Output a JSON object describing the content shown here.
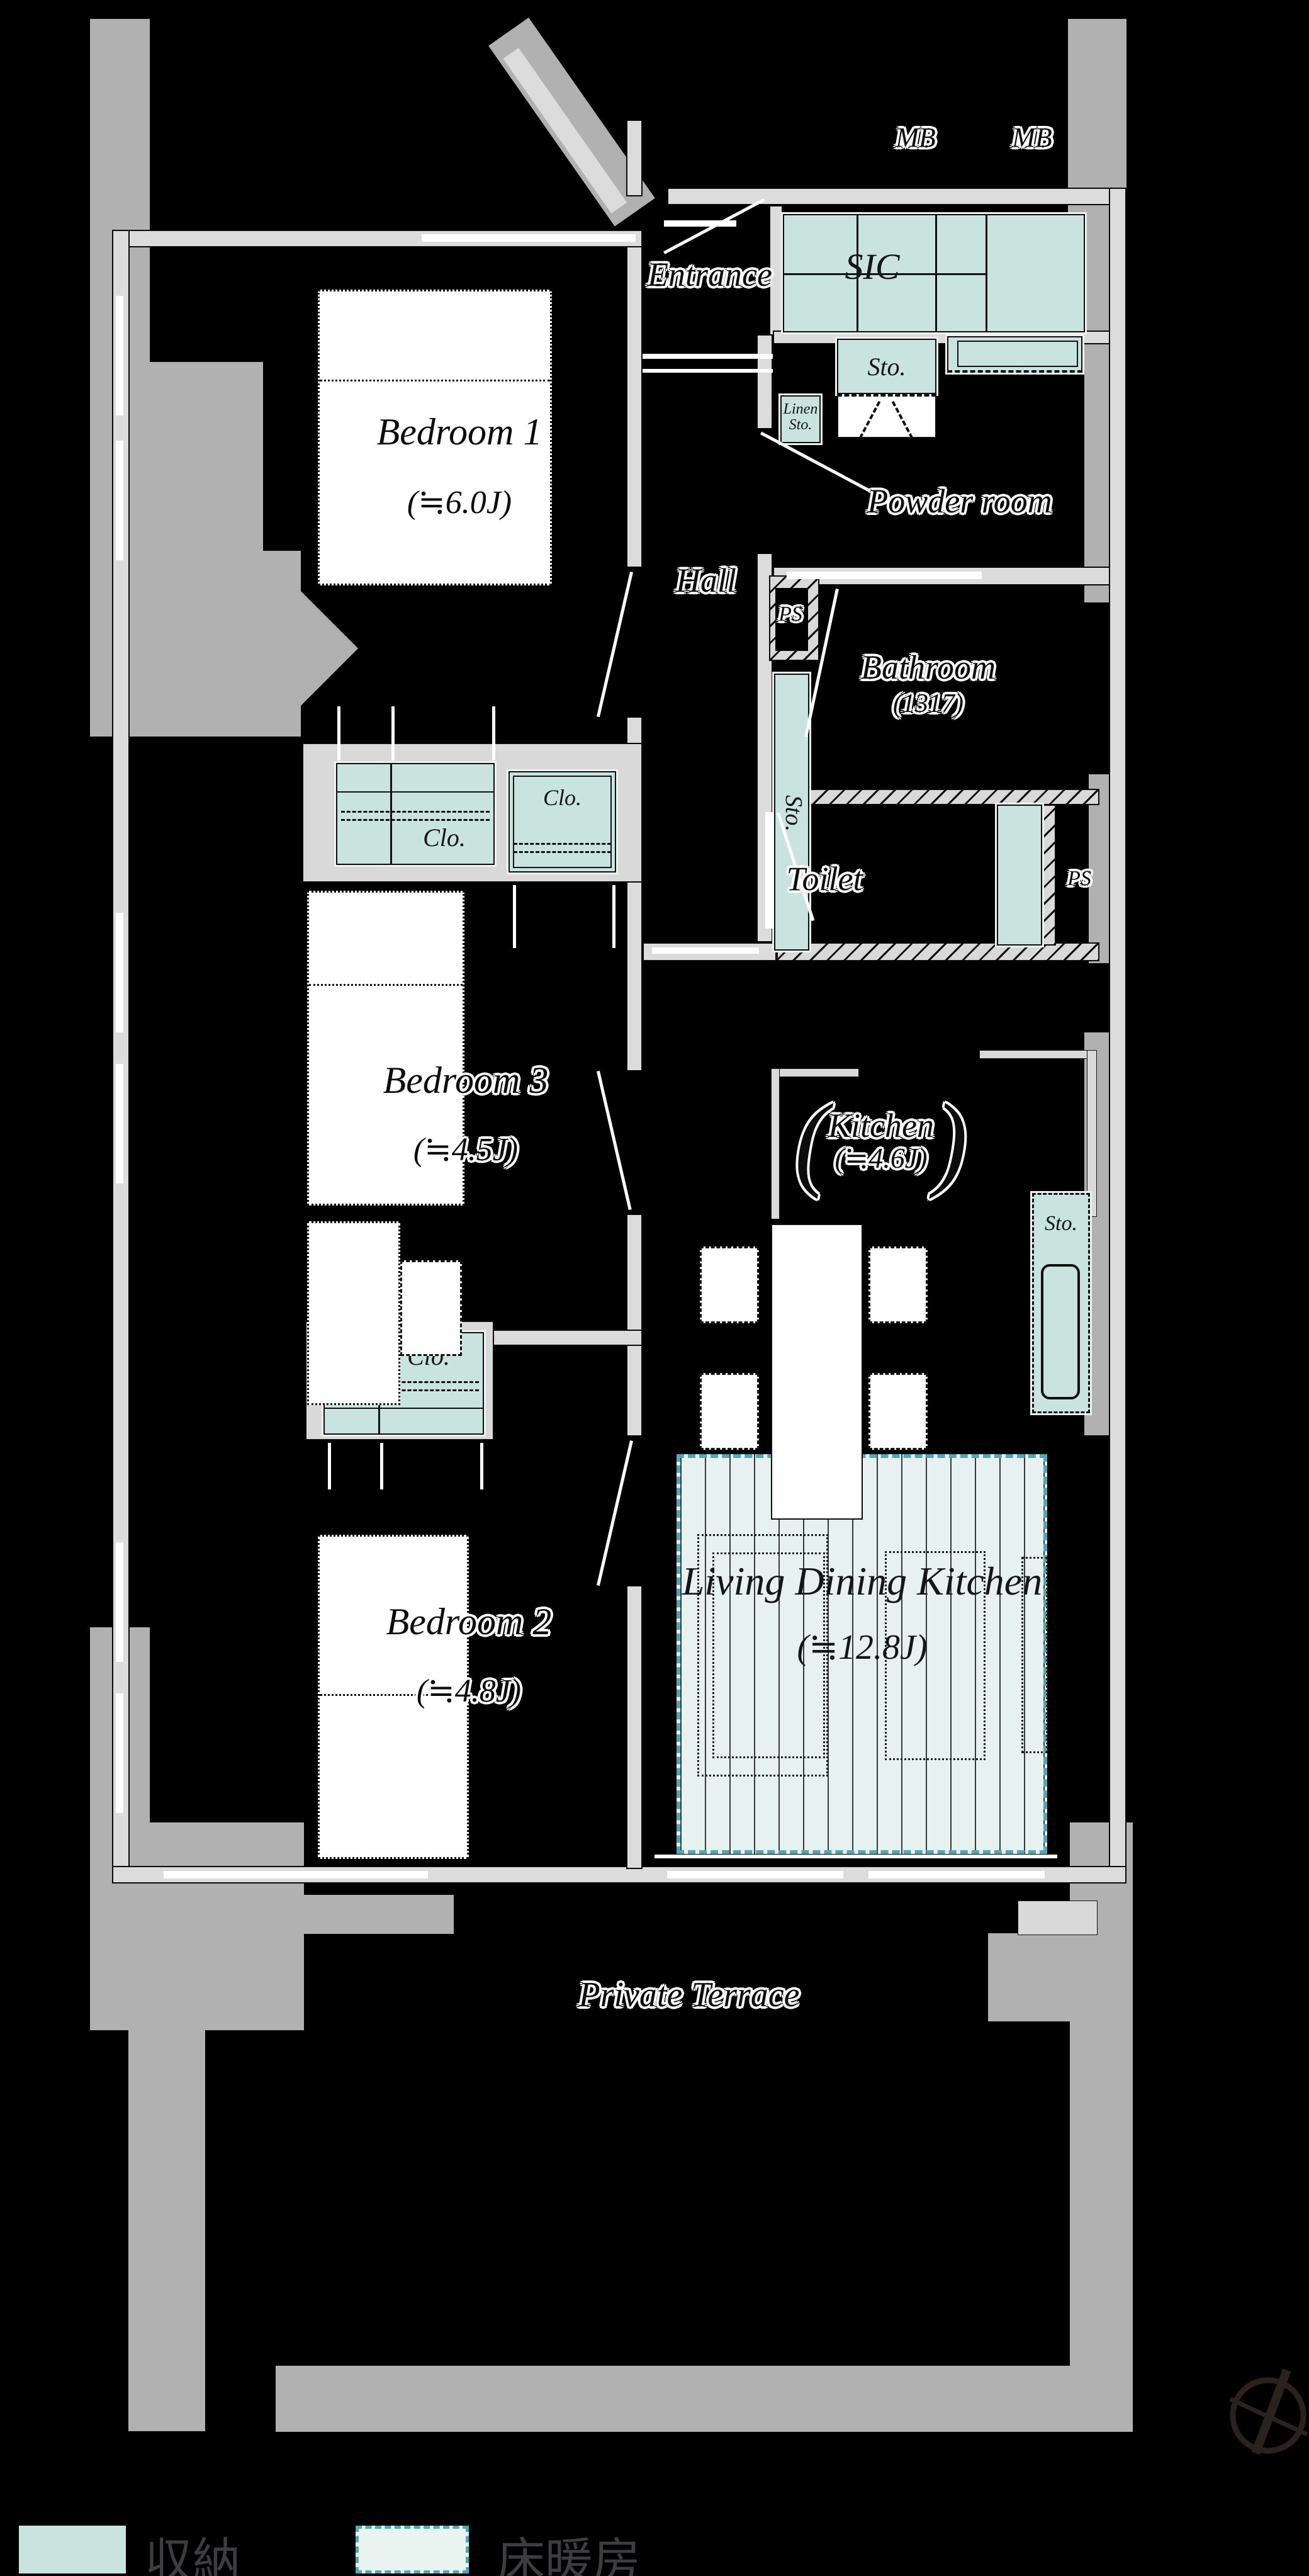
{
  "labels": {
    "mb": "MB",
    "sic": "SIC",
    "sto": "Sto.",
    "linen_1": "Linen",
    "linen_2": "Sto.",
    "clo": "Clo.",
    "ps": "PS",
    "entrance": "Entrance",
    "hall": "Hall",
    "powder_room": "Powder room",
    "bathroom": "Bathroom",
    "bathroom_size": "(1317)",
    "toilet": "Toilet",
    "bedroom1": "Bedroom 1",
    "bedroom1_size": "(≒6.0J)",
    "bedroom2": "Bedroom 2",
    "bedroom2_size": "(≒4.8J)",
    "bedroom3": "Bedroom 3",
    "bedroom3_size": "(≒4.5J)",
    "kitchen": "Kitchen",
    "kitchen_size": "(≒4.6J)",
    "paren_open": "(",
    "paren_close": ")",
    "ldk": "Living Dining Kitchen",
    "ldk_size": "(≒12.8J)",
    "terrace": "Private Terrace"
  },
  "legend": {
    "storage": "収納",
    "floor_heating": "床暖房"
  },
  "colors": {
    "background": "#000000",
    "storage": "#c9e4de",
    "floor_heating_fill": "#e7f2f0",
    "floor_heating_border": "#4fa8b8",
    "wall": "#dcdcdc",
    "concrete": "#b1b1b1",
    "label_ink": "#0c0c0c",
    "legend_ink": "#3c3c41"
  }
}
